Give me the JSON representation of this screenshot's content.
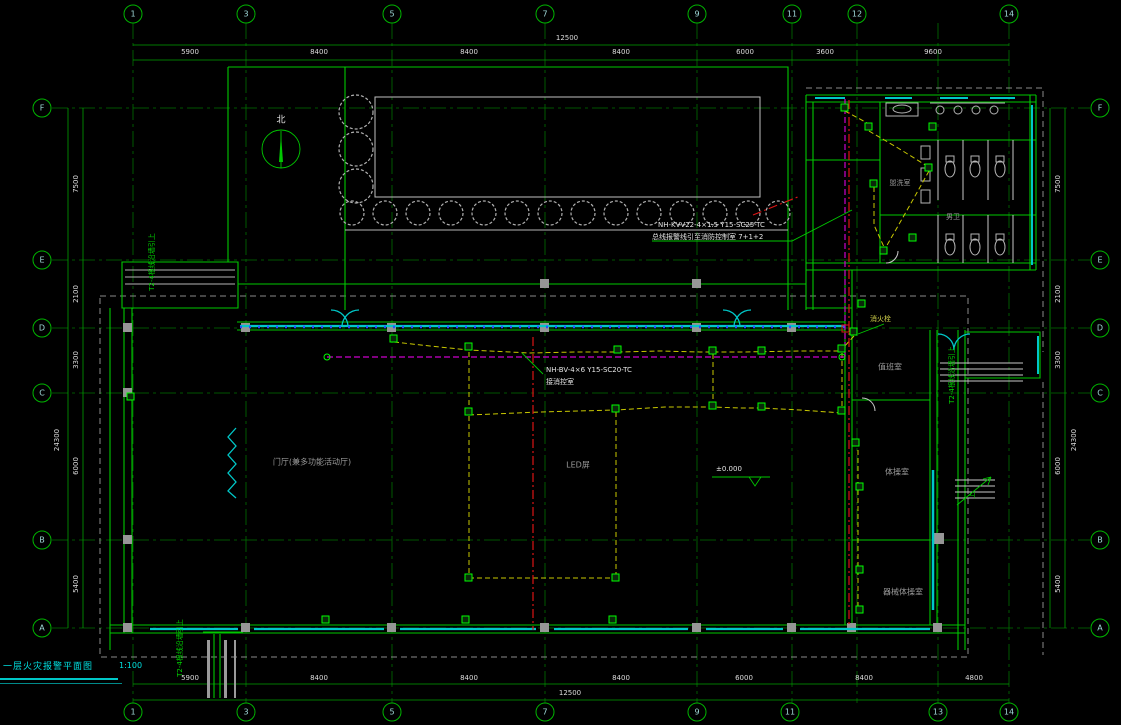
{
  "title_block": {
    "title": "一层火灾报警平面图",
    "scale": "1:100"
  },
  "grid": {
    "top": [
      "1",
      "3",
      "5",
      "7",
      "9",
      "11",
      "12",
      "14"
    ],
    "bottom": [
      "1",
      "3",
      "5",
      "7",
      "9",
      "11",
      "13",
      "14"
    ],
    "left": [
      "F",
      "E",
      "D",
      "C",
      "B",
      "A"
    ],
    "right": [
      "F",
      "E",
      "D",
      "C",
      "B",
      "A"
    ]
  },
  "dims": {
    "top": [
      "5900",
      "8400",
      "8400",
      "8400",
      "6000",
      "3600",
      "9600"
    ],
    "top_mid": "12500",
    "bottom": [
      "5900",
      "8400",
      "8400",
      "8400",
      "6000",
      "8400",
      "4800"
    ],
    "bottom_mid": "12500",
    "left": [
      "7500",
      "2100",
      "3300",
      "6000",
      "5400"
    ],
    "left_total": "24300",
    "right": [
      "7500",
      "2100",
      "3300",
      "6000",
      "5400"
    ],
    "right_total": "24300"
  },
  "rooms": {
    "hall": "门厅(兼多功能活动厅)",
    "led_screen": "LED屏",
    "duty_room": "值班室",
    "gym_room": "体操室",
    "equipment_room": "器械体操室",
    "washroom": "盥洗室",
    "mens_toilet": "男卫"
  },
  "annotations": {
    "north_label": "北",
    "elevation": "±0.000",
    "hydrant_label": "消火栓",
    "wire_main_l1": "NH-KVV22-4×1.5 Y15-SC25-TC",
    "wire_main_l2": "总线报警线引至消防控制室 7+1+2",
    "wire_ctrl_l1": "NH-BV-4×6 Y15-SC20-TC",
    "wire_ctrl_l2": "接消控室",
    "riser_left": "T2-4根线沿墙引上",
    "riser_right": "T2-4根线沿墙引上",
    "riser_bottom": "T2-4根线沿墙引上",
    "stair_up": "上"
  },
  "colors": {
    "line_green": "#00c800",
    "cyan": "#00c8c8",
    "yellow_wire": "#c8c800",
    "magenta_wire": "#cc00cc",
    "red_riser": "#dc1414",
    "column_gray": "#969696"
  }
}
